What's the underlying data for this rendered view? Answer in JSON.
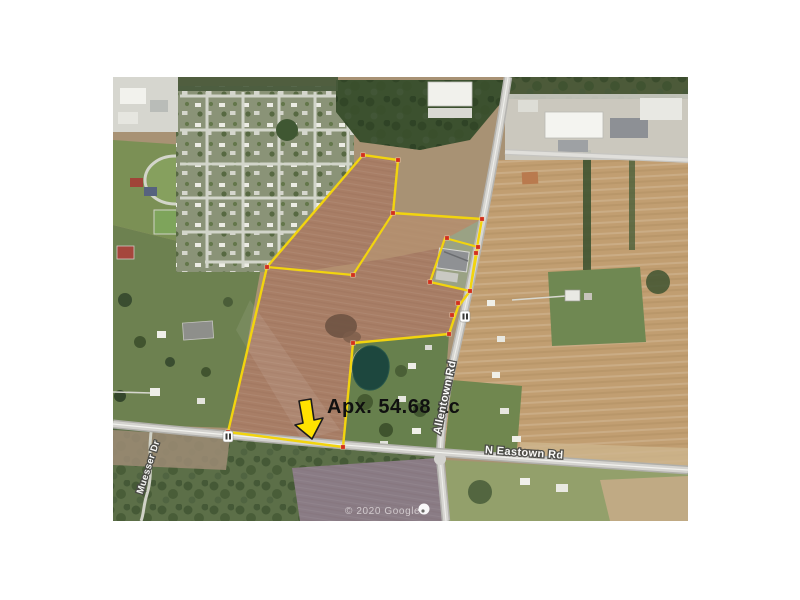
{
  "annotation": {
    "acreage_label": "Apx. 54.68 ac",
    "arrow_color": "#ffe200",
    "arrow_points": [
      [
        299,
        401
      ],
      [
        311,
        399
      ],
      [
        314,
        420
      ],
      [
        323,
        418
      ],
      [
        312,
        439
      ],
      [
        295,
        425
      ],
      [
        303,
        423
      ]
    ]
  },
  "road_labels": {
    "allentown": "Allentown Rd",
    "n_eastown": "N Eastown Rd",
    "muesser": "Muesser Dr"
  },
  "watermark": {
    "text": "© 2020 Google"
  },
  "parcel": {
    "outline_color": "#f2d40e",
    "marker_color": "#d2301c",
    "outer": [
      [
        363,
        155
      ],
      [
        398,
        160
      ],
      [
        393,
        213
      ],
      [
        482,
        219
      ],
      [
        476,
        253
      ],
      [
        470,
        291
      ],
      [
        458,
        307
      ],
      [
        449,
        334
      ],
      [
        353,
        343
      ],
      [
        343,
        447
      ],
      [
        228,
        432
      ],
      [
        267,
        267
      ]
    ],
    "building_exclusion": [
      [
        445,
        238
      ],
      [
        478,
        247
      ],
      [
        470,
        291
      ],
      [
        430,
        282
      ]
    ],
    "divider": [
      [
        267,
        267
      ],
      [
        353,
        275
      ],
      [
        393,
        213
      ]
    ],
    "markers": [
      [
        363,
        155
      ],
      [
        398,
        160
      ],
      [
        393,
        213
      ],
      [
        482,
        219
      ],
      [
        476,
        253
      ],
      [
        447,
        238
      ],
      [
        478,
        247
      ],
      [
        430,
        282
      ],
      [
        470,
        291
      ],
      [
        458,
        303
      ],
      [
        452,
        315
      ],
      [
        449,
        334
      ],
      [
        353,
        343
      ],
      [
        343,
        447
      ],
      [
        228,
        432
      ],
      [
        267,
        267
      ],
      [
        353,
        275
      ]
    ]
  },
  "icons": {
    "route_shield": "route-shield-icon",
    "map_pin": "map-pin-icon"
  }
}
